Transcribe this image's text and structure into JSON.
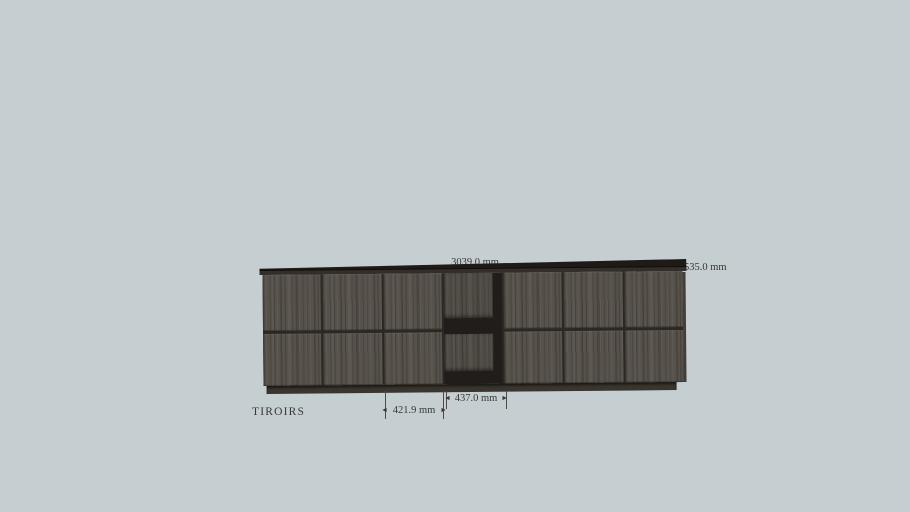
{
  "viewport": {
    "product_label": "TIROIRS"
  },
  "annotations": {
    "total_width": {
      "value": "3039.0 mm"
    },
    "depth": {
      "value": "535.0 mm"
    },
    "niche_width": {
      "value": "437.0 mm"
    },
    "drawer_width": {
      "value": "421.9 mm"
    }
  },
  "icons": {
    "arrow_left": "◄",
    "arrow_right": "►"
  },
  "colors": {
    "background": "#c5ced1",
    "wood_base": "#56514a",
    "panel_gap": "#2b2723",
    "top_slab": "#1d1a17",
    "niche_interior": "#211d1a",
    "plinth": "#3a352e",
    "dimension_text": "#3b3734",
    "dimension_line": "#4e4a46"
  },
  "cabinet": {
    "drawer_rows": 2,
    "columns": [
      {
        "type": "drawers"
      },
      {
        "type": "drawers"
      },
      {
        "type": "drawers"
      },
      {
        "type": "open-niche"
      },
      {
        "type": "drawers"
      },
      {
        "type": "drawers"
      },
      {
        "type": "drawers"
      }
    ]
  }
}
